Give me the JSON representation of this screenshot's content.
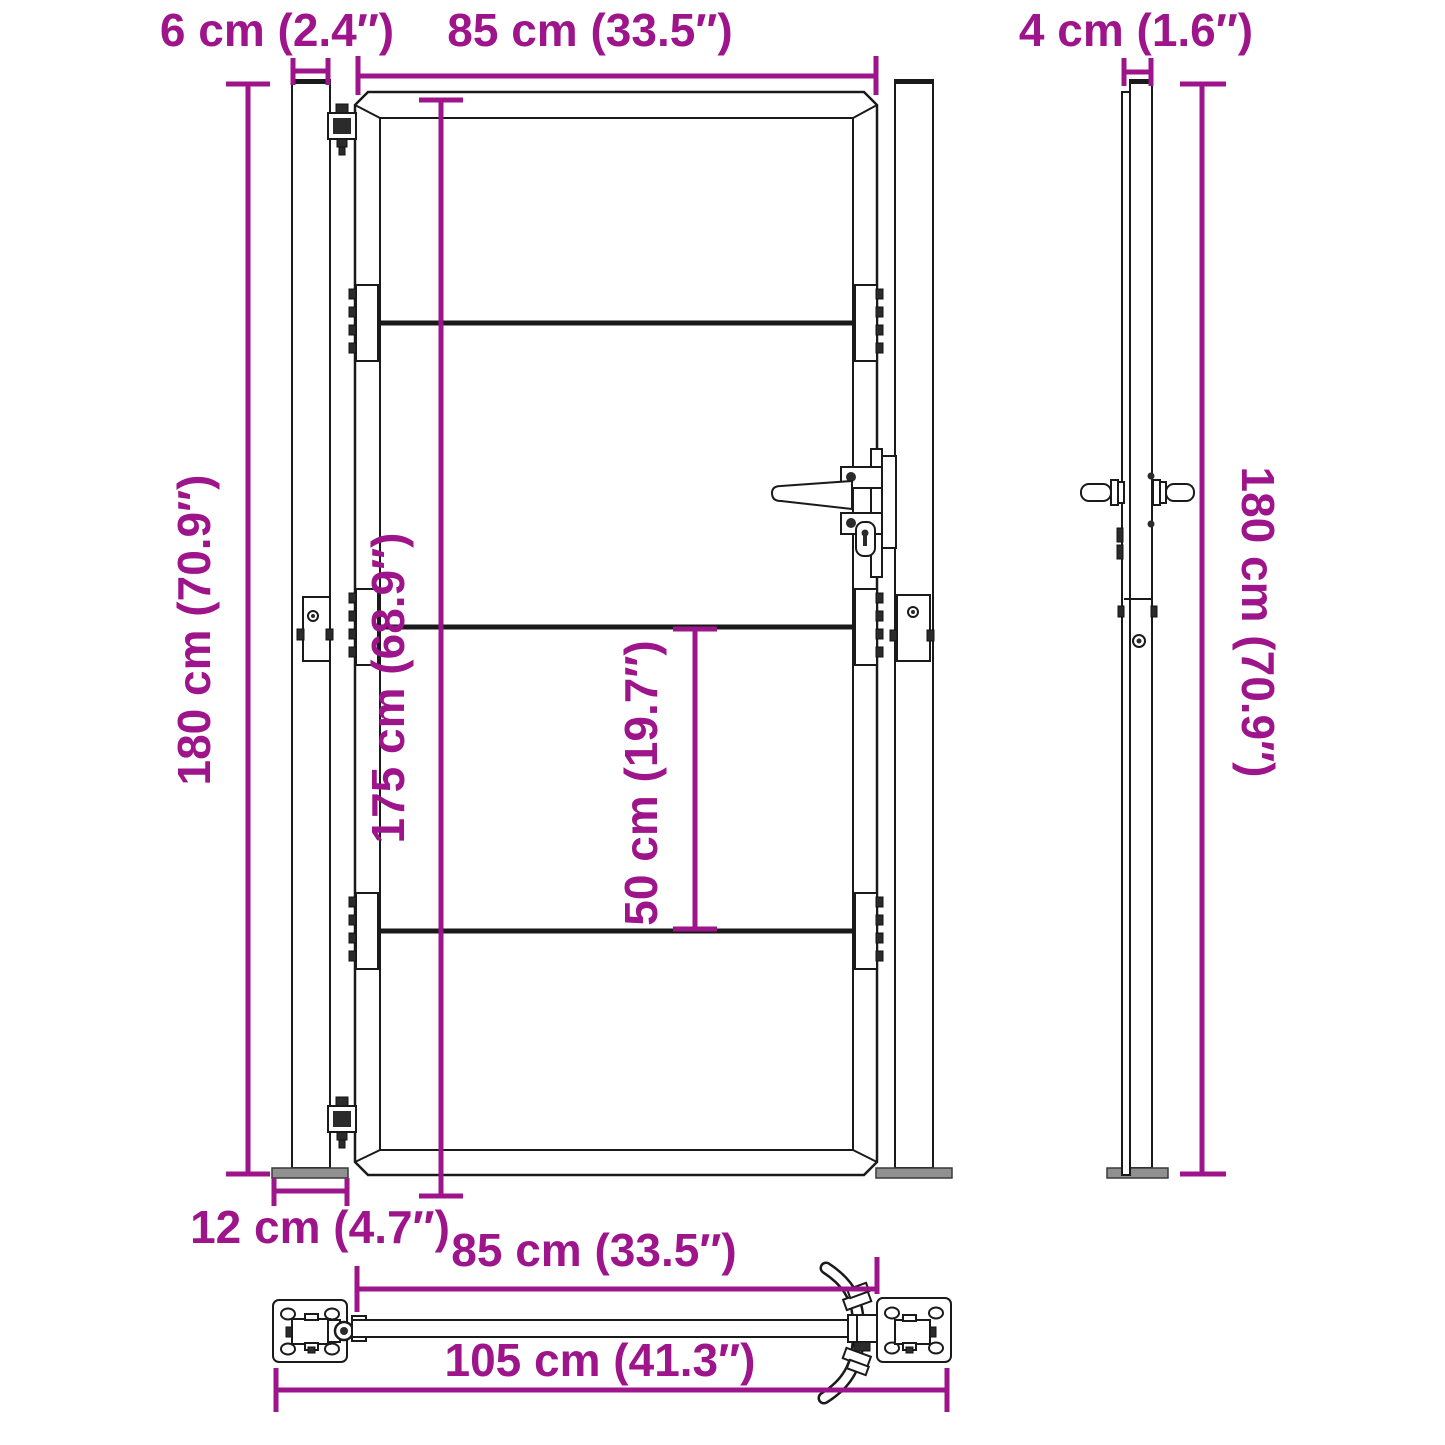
{
  "diagram": {
    "kind": "garden-gate-dimension-drawing",
    "accent_color": "#9E148A",
    "line_color": "#1a1a1a",
    "metal_fill": "#909090",
    "views": {
      "front": {
        "dims": {
          "post_width": "6 cm (2.4″)",
          "gate_width": "85 cm (33.5″)",
          "total_height": "180 cm (70.9″)",
          "gate_height": "175 cm (68.9″)",
          "rail_spacing": "50 cm (19.7″)",
          "base_plate_width": "12 cm (4.7″)"
        }
      },
      "side": {
        "dims": {
          "profile_depth": "4 cm (1.6″)",
          "total_height": "180 cm (70.9″)"
        }
      },
      "top": {
        "dims": {
          "gate_width": "85 cm (33.5″)",
          "total_width": "105 cm (41.3″)"
        }
      }
    }
  }
}
